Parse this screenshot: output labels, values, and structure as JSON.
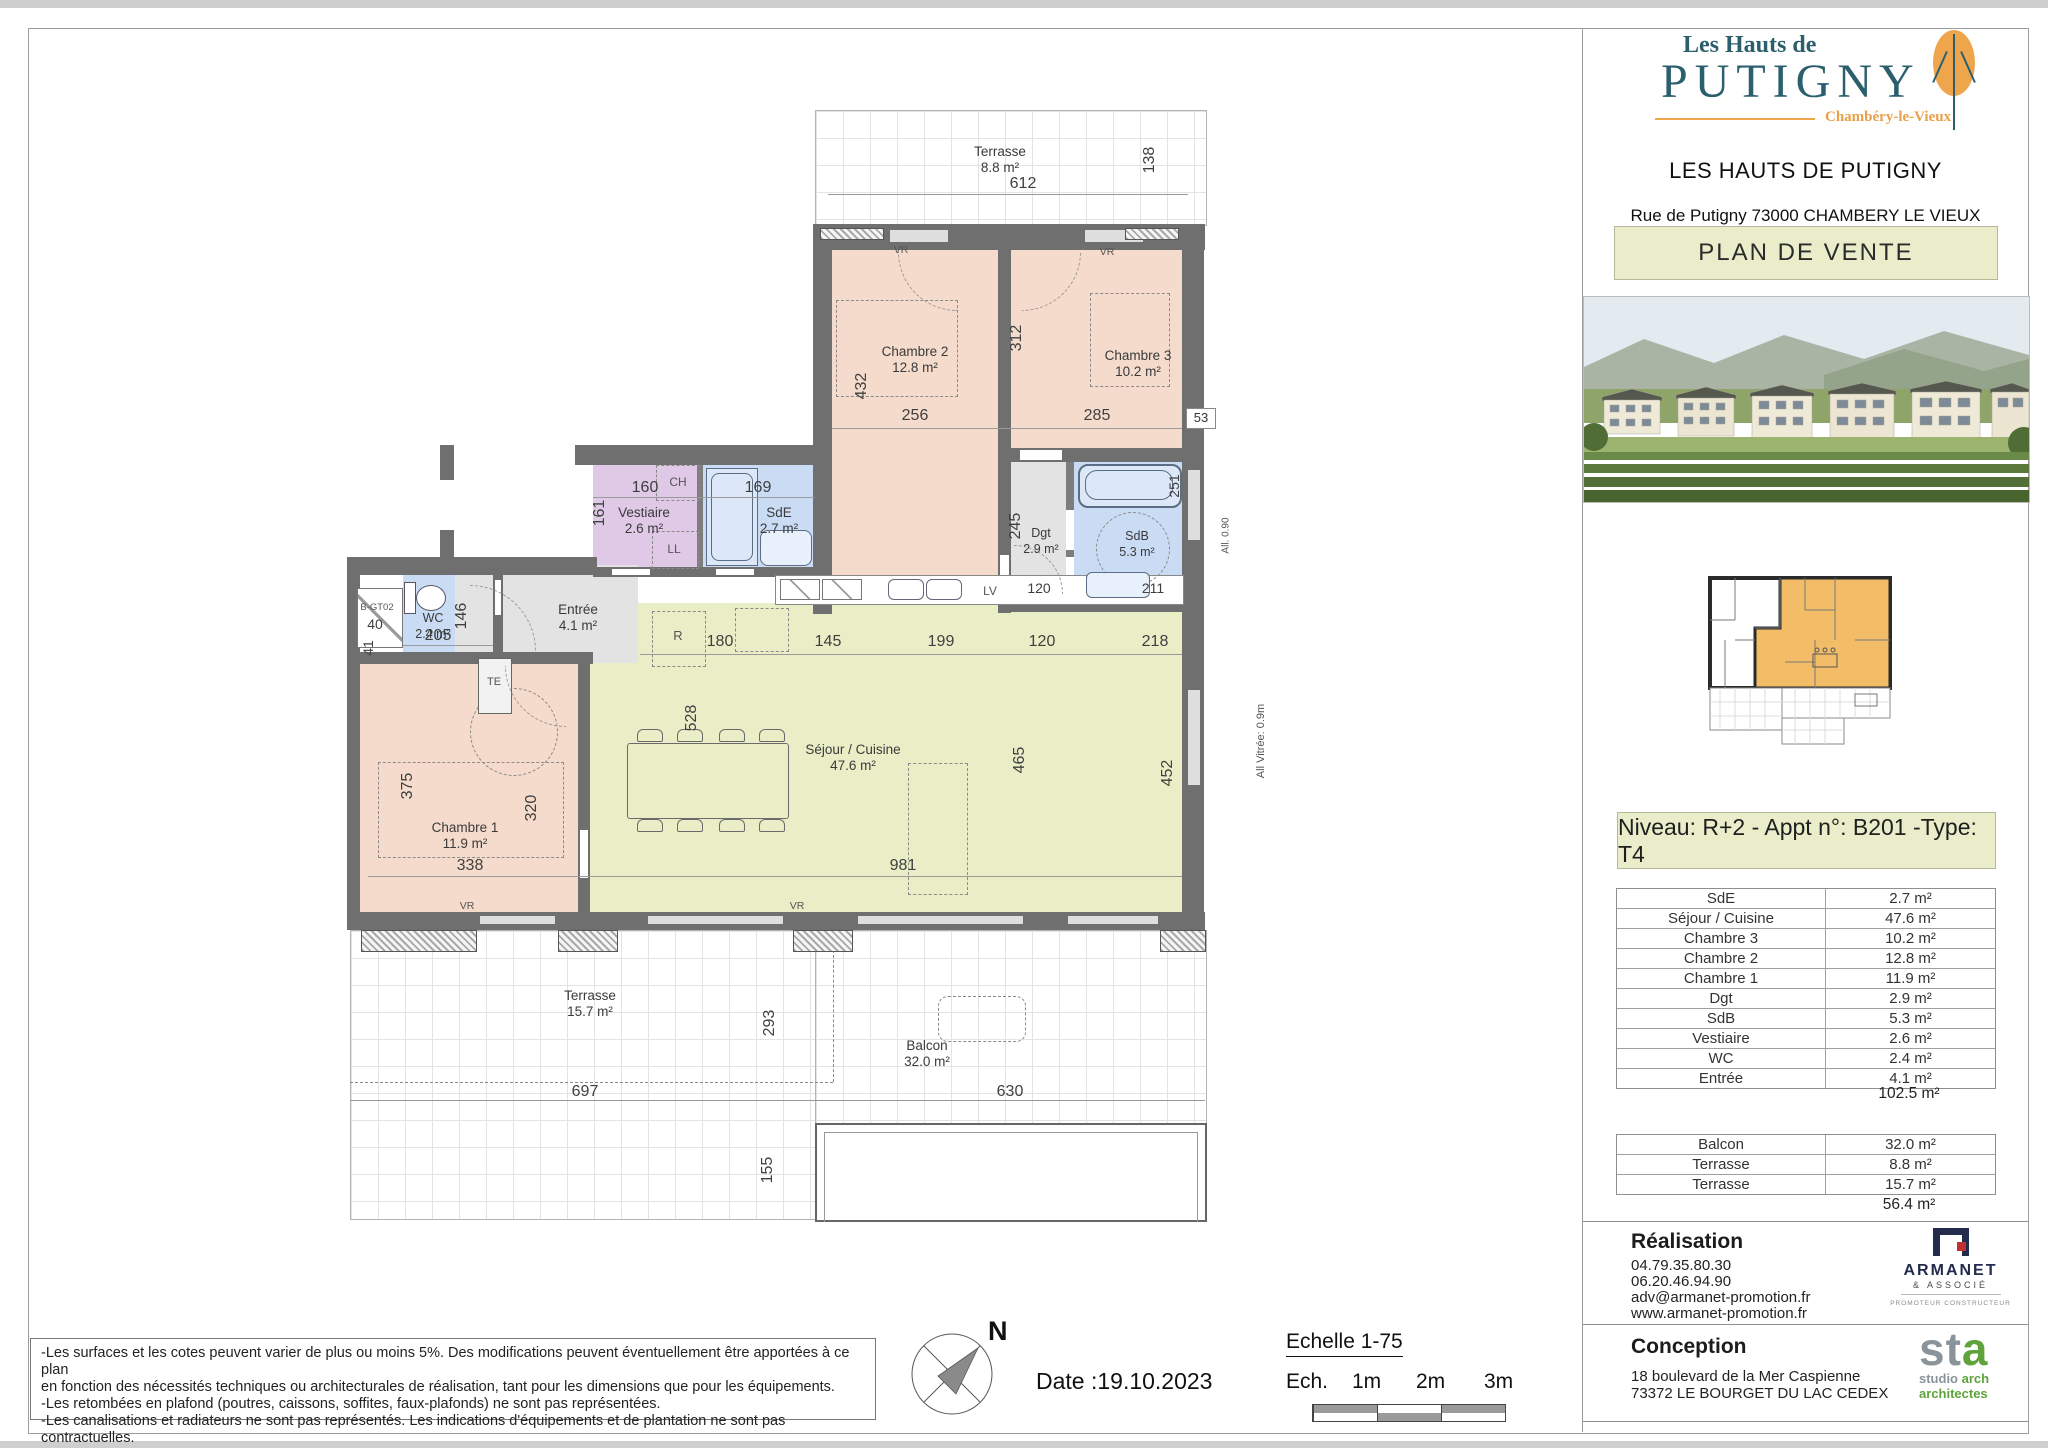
{
  "colors": {
    "banner_green": "#e9edc9",
    "room_salmon": "#f4dbcc",
    "room_blue": "#c9dcf4",
    "room_purple": "#dfc9e6",
    "room_sejour": "#eaeec6",
    "room_gray": "#e3e3e3",
    "wall_gray": "#6f6f6f",
    "logo_teal": "#2c5f6e",
    "logo_orange": "#efa54c",
    "armanet_navy": "#232c4d",
    "sta_green": "#5fa33c"
  },
  "sidebar": {
    "logo": {
      "line1": "Les Hauts de",
      "line2": "PUTIGNY",
      "subtitle": "Chambéry-le-Vieux"
    },
    "project_title": "LES HAUTS DE PUTIGNY",
    "address": "Rue de Putigny 73000 CHAMBERY LE VIEUX",
    "plan_banner": "PLAN DE VENTE",
    "unit_banner": "Niveau: R+2  - Appt n°: B201 -Type: T4",
    "areas_table": {
      "rows": [
        [
          "SdE",
          "2.7 m²"
        ],
        [
          "Séjour / Cuisine",
          "47.6 m²"
        ],
        [
          "Chambre 3",
          "10.2 m²"
        ],
        [
          "Chambre 2",
          "12.8 m²"
        ],
        [
          "Chambre 1",
          "11.9 m²"
        ],
        [
          "Dgt",
          "2.9 m²"
        ],
        [
          "SdB",
          "5.3 m²"
        ],
        [
          "Vestiaire",
          "2.6 m²"
        ],
        [
          "WC",
          "2.4 m²"
        ],
        [
          "Entrée",
          "4.1 m²"
        ]
      ],
      "total": "102.5 m²"
    },
    "exterior_table": {
      "rows": [
        [
          "Balcon",
          "32.0 m²"
        ],
        [
          "Terrasse",
          "8.8 m²"
        ],
        [
          "Terrasse",
          "15.7 m²"
        ]
      ],
      "total": "56.4 m²"
    },
    "realisation": {
      "heading": "Réalisation",
      "lines": [
        "04.79.35.80.30",
        "06.20.46.94.90",
        "adv@armanet-promotion.fr",
        "www.armanet-promotion.fr"
      ],
      "logo_name": "ARMANET",
      "logo_sub": "& ASSOCIÉ",
      "logo_tagline": "PROMOTEUR CONSTRUCTEUR"
    },
    "conception": {
      "heading": "Conception",
      "lines": [
        "18 boulevard de la Mer Caspienne",
        "73372 LE BOURGET DU LAC CEDEX"
      ],
      "logo_big": "sta",
      "logo_l1a": "studio ",
      "logo_l1b": "arch",
      "logo_l2": "architectes"
    }
  },
  "footer": {
    "disclaimer_lines": [
      "-Les surfaces et les cotes peuvent varier de plus ou moins 5%. Des modifications peuvent éventuellement être apportées à ce plan",
      "en fonction des nécessités techniques ou architecturales de réalisation, tant pour les dimensions que pour les équipements.",
      "-Les retombées en plafond (poutres, caissons, soffites, faux-plafonds) ne sont pas représentées.",
      "-Les canalisations et radiateurs ne sont pas représentés. Les indications d'équipements et de plantation ne sont pas contractuelles."
    ],
    "compass_label": "N",
    "date": "Date :19.10.2023",
    "scale_title": "Echelle 1-75",
    "scale_labels": [
      "Ech.",
      "1m",
      "2m",
      "3m"
    ]
  },
  "plan": {
    "rooms": {
      "terrasse_top": {
        "name": "Terrasse",
        "area": "8.8 m²"
      },
      "chambre2": {
        "name": "Chambre 2",
        "area": "12.8 m²"
      },
      "chambre3": {
        "name": "Chambre 3",
        "area": "10.2 m²"
      },
      "vestiaire": {
        "name": "Vestiaire",
        "area": "2.6 m²"
      },
      "sde": {
        "name": "SdE",
        "area": "2.7 m²"
      },
      "wc": {
        "name": "WC",
        "area": "2.4 m²"
      },
      "entree": {
        "name": "Entrée",
        "area": "4.1 m²"
      },
      "dgt": {
        "name": "Dgt",
        "area": "2.9 m²"
      },
      "sdb": {
        "name": "SdB",
        "area": "5.3 m²"
      },
      "sejour": {
        "name": "Séjour / Cuisine",
        "area": "47.6 m²"
      },
      "chambre1": {
        "name": "Chambre 1",
        "area": "11.9 m²"
      },
      "terrasse_bottom": {
        "name": "Terrasse",
        "area": "15.7 m²"
      },
      "balcon": {
        "name": "Balcon",
        "area": "32.0 m²"
      }
    },
    "dims": {
      "d612": "612",
      "d138": "138",
      "d432": "432",
      "d256": "256",
      "d312": "312",
      "d285": "285",
      "d53": "53",
      "d160": "160",
      "d161": "161",
      "d169": "169",
      "d146": "146",
      "d205": "205",
      "d41": "41",
      "d40": "40",
      "d245": "245",
      "d120a": "120",
      "d120b": "120",
      "d211": "211",
      "d251": "251",
      "d180": "180",
      "d145": "145",
      "d199": "199",
      "d218": "218",
      "d528": "528",
      "d465": "465",
      "d981": "981",
      "d452": "452",
      "d375": "375",
      "d320": "320",
      "d338": "338",
      "d697": "697",
      "d293": "293",
      "d155": "155",
      "d630": "630"
    },
    "tags": {
      "vr": "VR",
      "ch": "CH",
      "ll": "LL",
      "te": "TE",
      "r": "R",
      "lv": "LV",
      "b_gt02": "B-GT02",
      "all_090": "All. 0.90",
      "all_vitree": "All Vitrée: 0.9m"
    }
  }
}
